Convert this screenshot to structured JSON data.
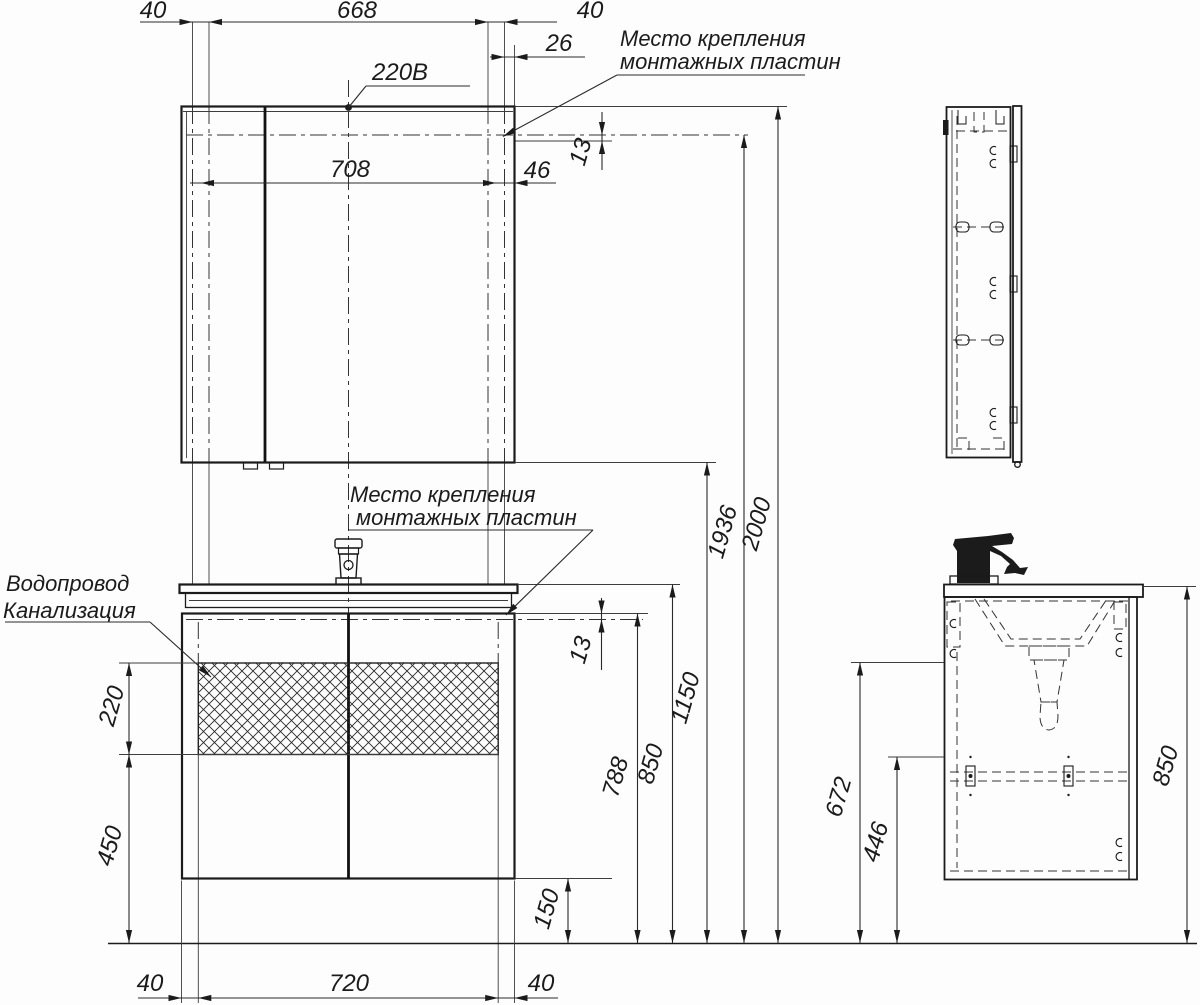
{
  "labels": {
    "power_supply": "220В",
    "mirror_mounting_line1": "Место крепления",
    "mirror_mounting_line2": "монтажных пластин",
    "vanity_mounting_line1": "Место крепления",
    "vanity_mounting_line2": "монтажных пластин",
    "water_supply": "Водопровод",
    "sewerage": "Канализация"
  },
  "dimensions": {
    "top": {
      "left_plate_width": "40",
      "between_plates": "668",
      "right_plate_width": "40",
      "plate_edge_offset": "26",
      "holes_span": "708",
      "hole_edge_offset": "46",
      "plate_height_offset": "13"
    },
    "heights": {
      "total": "2000",
      "mounting_plates": "1936",
      "mirror_bottom": "1150",
      "countertop": "850",
      "cabinet_top": "788",
      "vanity_plate_offset": "13",
      "floor_clearance": "150"
    },
    "service_window": {
      "height": "220",
      "below_height": "450"
    },
    "base": {
      "left_offset": "40",
      "width": "720",
      "right_offset": "40"
    },
    "side": {
      "mount_height": "672",
      "drawer_height": "446",
      "total_height": "850"
    }
  }
}
